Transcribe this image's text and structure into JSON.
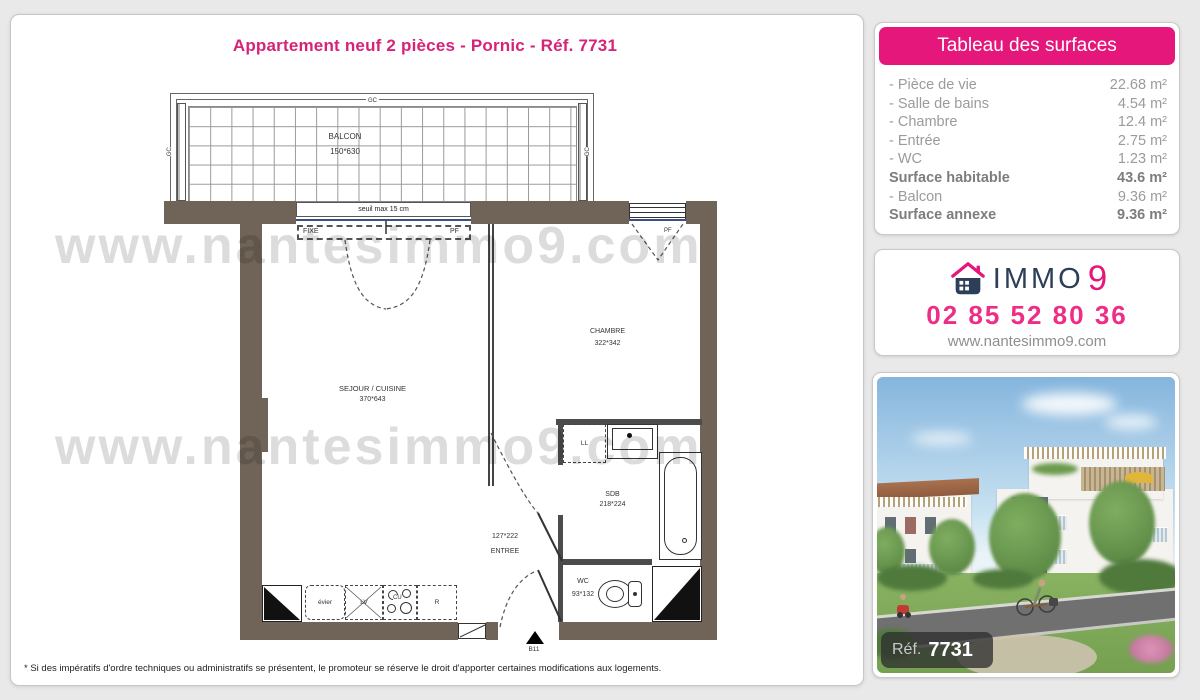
{
  "page": {
    "title": "Appartement neuf 2 pièces - Pornic - Réf. 7731",
    "footnote": "* Si des impératifs d'ordre techniques ou administratifs se présentent, le promoteur se réserve le droit d'apporter certaines modifications aux logements.",
    "watermark": "www.nantesimmo9.com"
  },
  "surfaces": {
    "header": "Tableau des surfaces",
    "rows": [
      {
        "label": "- Pièce de vie",
        "value": "22.68 m²",
        "bold": false
      },
      {
        "label": "- Salle de bains",
        "value": "4.54 m²",
        "bold": false
      },
      {
        "label": "- Chambre",
        "value": "12.4 m²",
        "bold": false
      },
      {
        "label": "- Entrée",
        "value": "2.75 m²",
        "bold": false
      },
      {
        "label": "- WC",
        "value": "1.23 m²",
        "bold": false
      },
      {
        "label": "Surface habitable",
        "value": "43.6 m²",
        "bold": true
      },
      {
        "label": "- Balcon",
        "value": "9.36 m²",
        "bold": false
      },
      {
        "label": "Surface annexe",
        "value": "9.36 m²",
        "bold": true
      }
    ]
  },
  "agency": {
    "brand_name": "IMMO",
    "brand_number": "9",
    "phone": "02 85 52 80 36",
    "website": "www.nantesimmo9.com"
  },
  "photo": {
    "ref_label": "Réf.",
    "ref_value": "7731"
  },
  "floorplan": {
    "balcony": {
      "name": "BALCON",
      "dim": "150*630",
      "rail_label": "GC"
    },
    "window_note": "seuil max 15 cm",
    "window_fixed": "FIXE",
    "window_pf": "PF",
    "bedroom_window": "PF",
    "living": {
      "name": "SEJOUR / CUISINE",
      "dim": "370*643"
    },
    "bedroom": {
      "name": "CHAMBRE",
      "dim": "322*342"
    },
    "bathroom": {
      "name": "SDB",
      "dim": "218*224"
    },
    "entry": {
      "name": "ENTREE",
      "dim": "127*222"
    },
    "wc": {
      "name": "WC",
      "dim": "93*132"
    },
    "appliances": {
      "washer": "LL",
      "sink": "évier",
      "dishwasher": "LV",
      "cooktop": "CU",
      "fridge": "R"
    },
    "unit_ref": "B11"
  },
  "colors": {
    "accent": "#e5177b",
    "navy": "#2c3e58",
    "wall": "#6f6457"
  }
}
